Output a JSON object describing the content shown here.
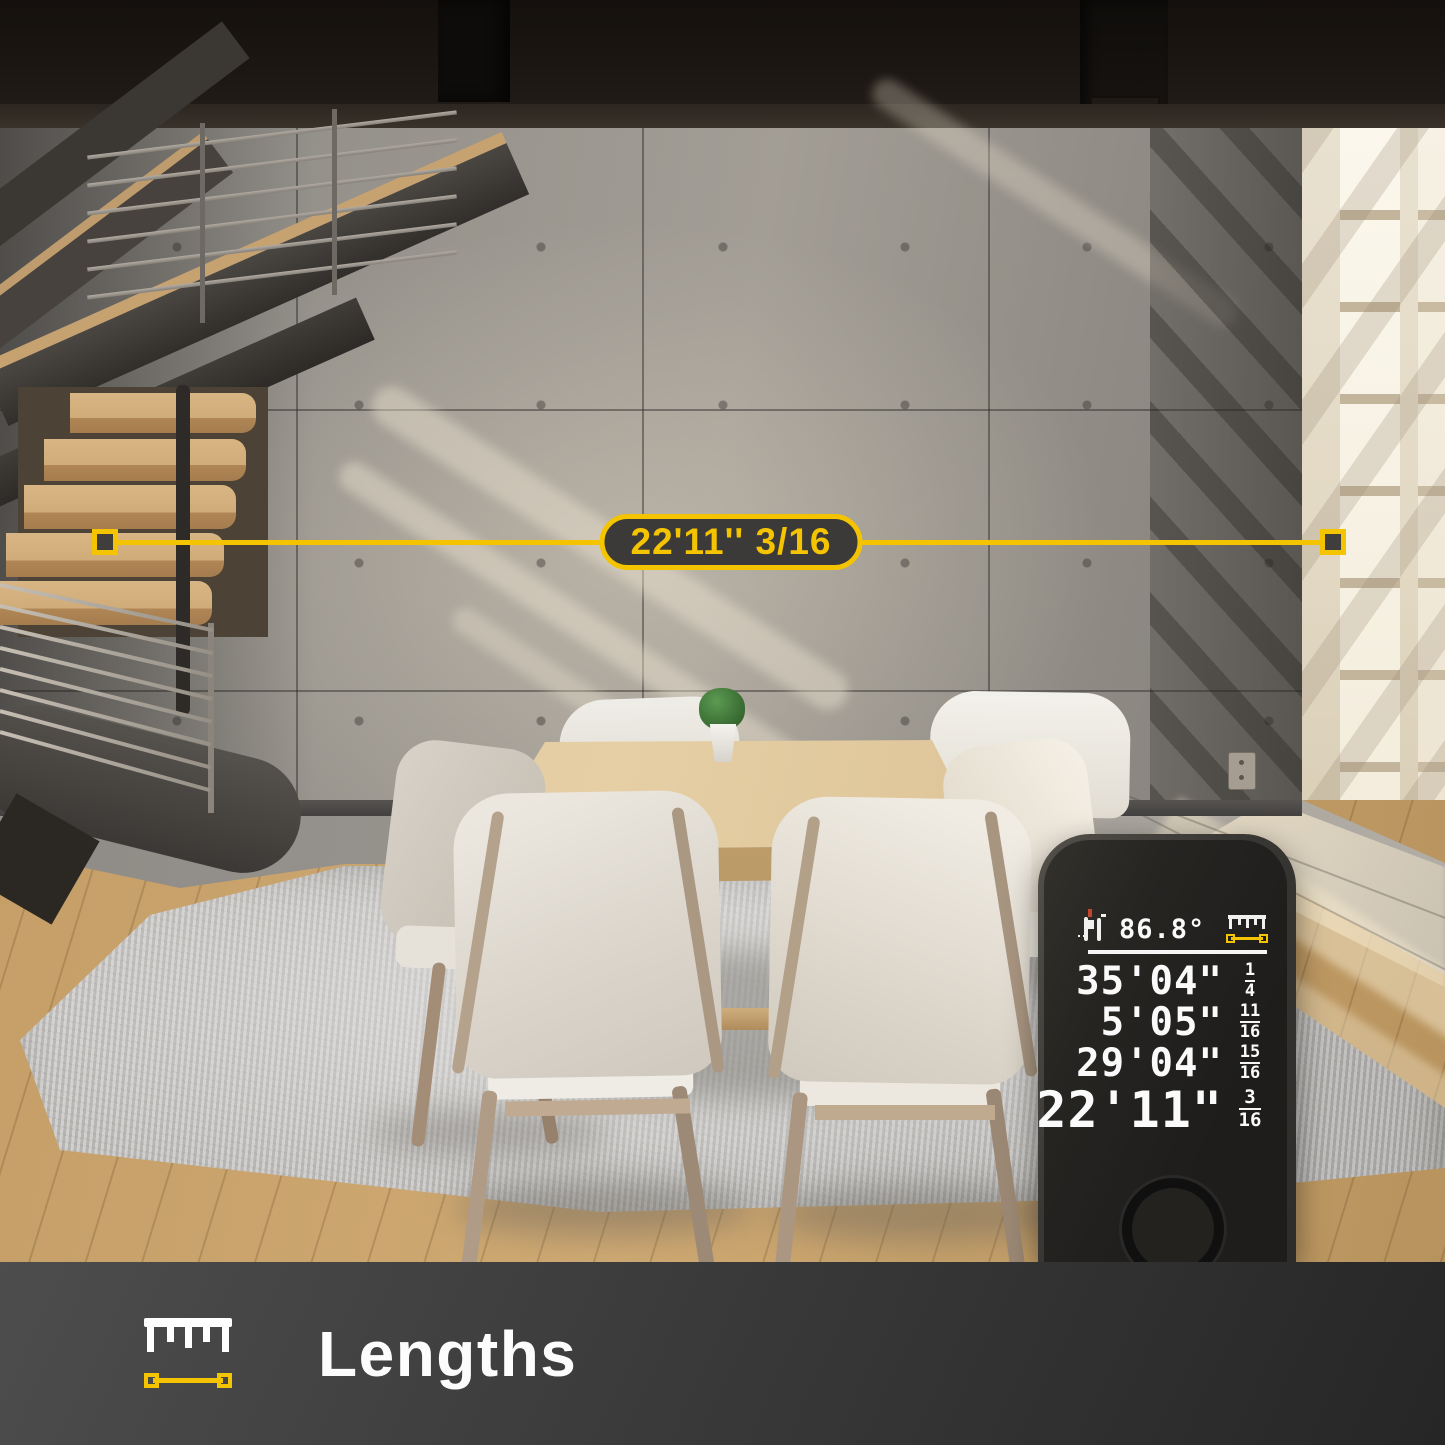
{
  "overlay": {
    "label": "22'11'' 3/16"
  },
  "device": {
    "status": {
      "temperature": "86.8°"
    },
    "readings": [
      {
        "value": "35'04\"",
        "num": "1",
        "den": "4"
      },
      {
        "value": "5'05\"",
        "num": "11",
        "den": "16"
      },
      {
        "value": "29'04\"",
        "num": "15",
        "den": "16"
      },
      {
        "value": "22'11\"",
        "num": "3",
        "den": "16"
      }
    ]
  },
  "footer": {
    "label": "Lengths"
  },
  "icons": {
    "laser_meter": "device pictogram with red laser tick",
    "battery": "battery outline",
    "bluetooth": "bluetooth rune",
    "ruler": "white ruler ticks",
    "measure_line": "yellow line with square endpoints"
  },
  "colors": {
    "accent-yellow": "#F5C400",
    "display-white": "#FAFAFA",
    "pill-dark": "#3B3A38"
  }
}
